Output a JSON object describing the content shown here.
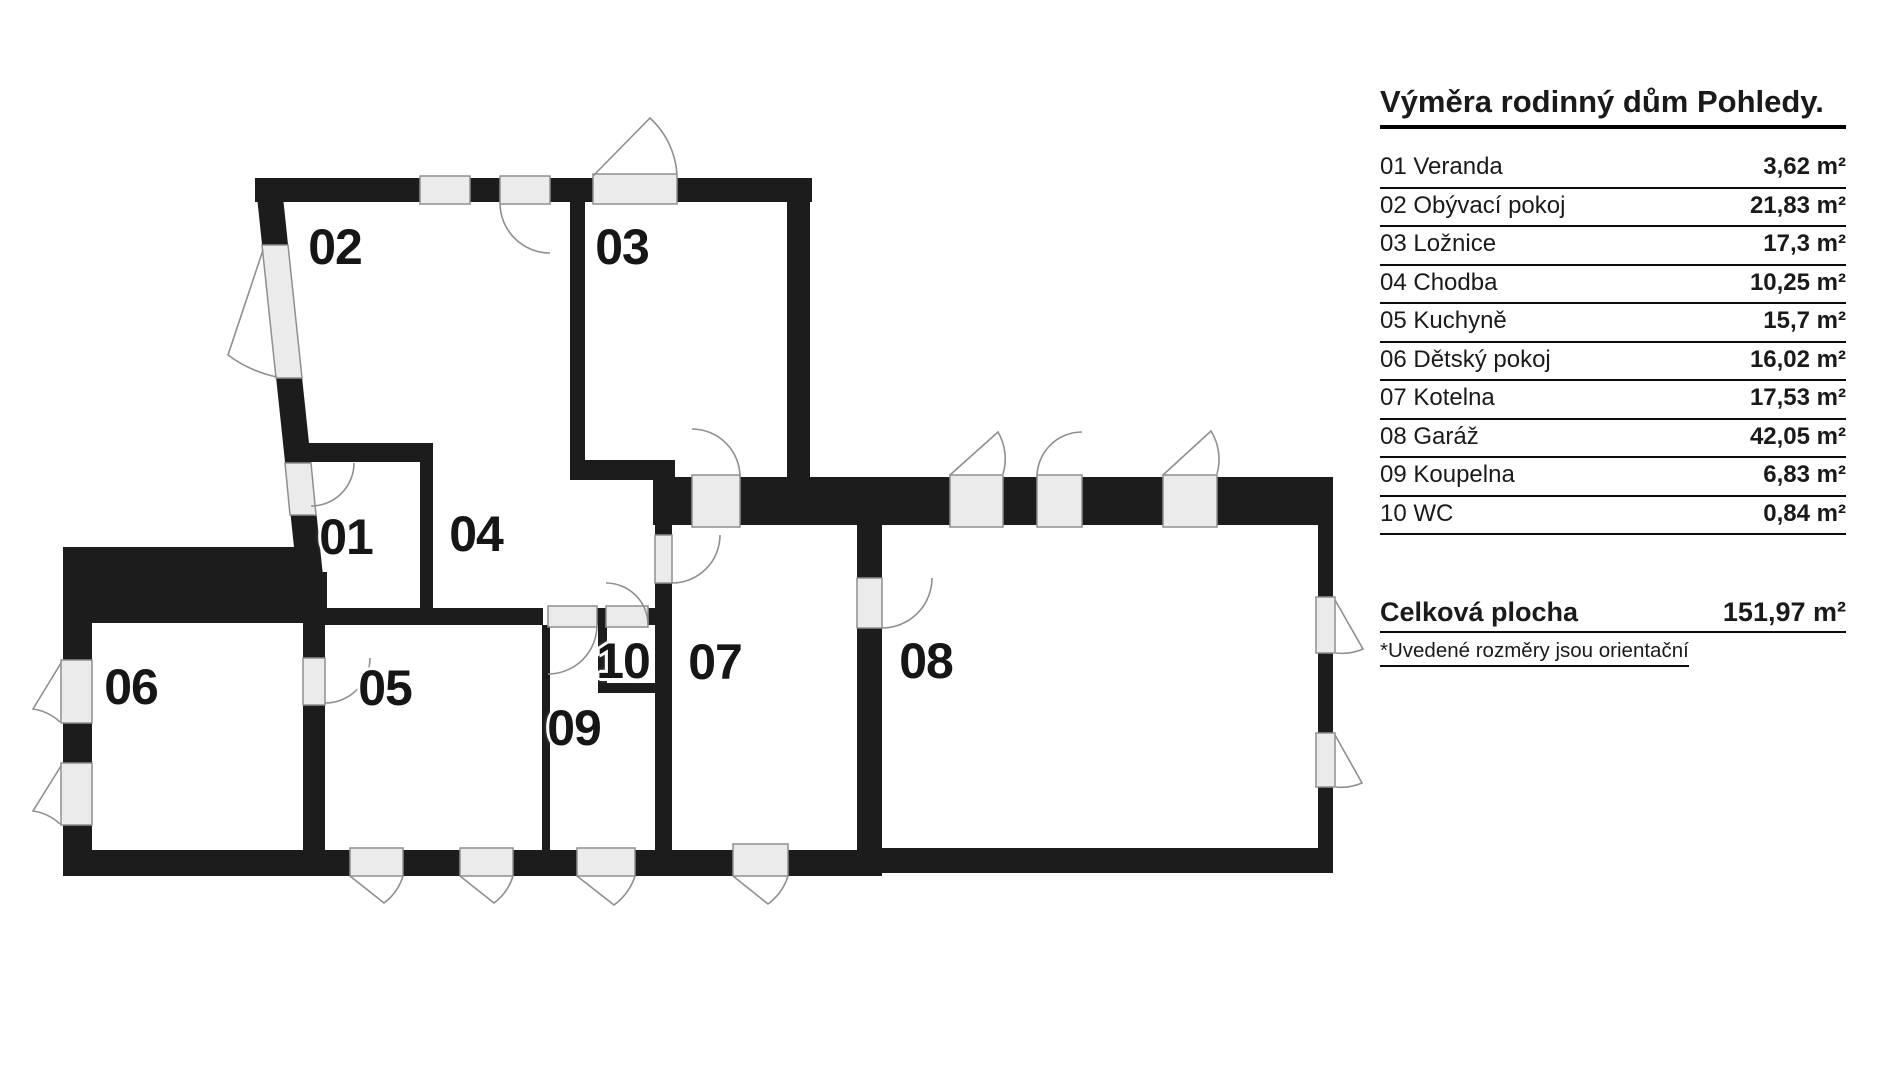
{
  "title": "Výměra rodinný dům Pohledy.",
  "colors": {
    "wall": "#1c1c1c",
    "opening_fill": "#ebebeb",
    "opening_stroke": "#8f8f8f",
    "arc": "#8f8f8f"
  },
  "legend": {
    "total_label": "Celková plocha",
    "total_value": "151,97 m²",
    "note": "*Uvedené rozměry jsou orientační"
  },
  "rooms": [
    {
      "num": "01",
      "name": "Veranda",
      "area": "3,62 m²"
    },
    {
      "num": "02",
      "name": "Obývací pokoj",
      "area": "21,83 m²"
    },
    {
      "num": "03",
      "name": "Ložnice",
      "area": "17,3 m²"
    },
    {
      "num": "04",
      "name": "Chodba",
      "area": "10,25 m²"
    },
    {
      "num": "05",
      "name": "Kuchyně",
      "area": "15,7 m²"
    },
    {
      "num": "06",
      "name": "Dětský pokoj",
      "area": "16,02 m²"
    },
    {
      "num": "07",
      "name": "Kotelna",
      "area": "17,53 m²"
    },
    {
      "num": "08",
      "name": "Garáž",
      "area": "42,05 m²"
    },
    {
      "num": "09",
      "name": "Koupelna",
      "area": "6,83 m²"
    },
    {
      "num": "10",
      "name": "WC",
      "area": "0,84 m²"
    }
  ]
}
